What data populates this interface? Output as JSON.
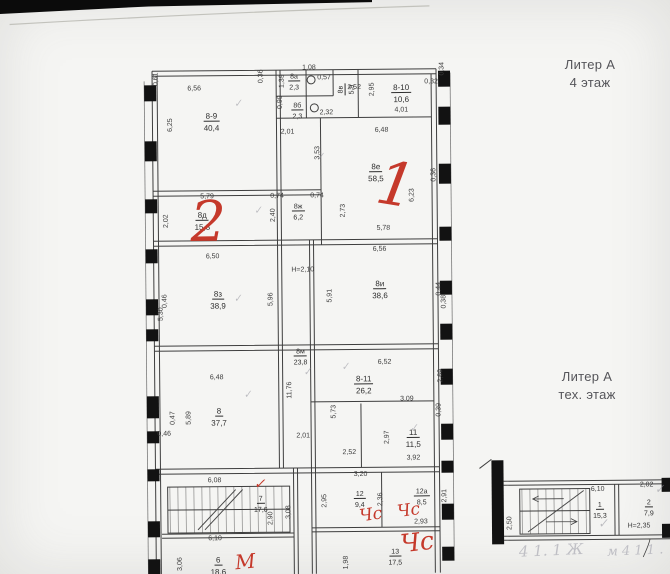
{
  "page": {
    "floor_labels": [
      {
        "line1": "Литер А",
        "line2": "4 этаж"
      },
      {
        "line1": "Литер А",
        "line2": "тех. этаж"
      }
    ]
  },
  "colors": {
    "red": "#c5392b",
    "pencil": "#a6a6b0",
    "tick": "#8f8f99"
  },
  "plan": {
    "rooms": [
      {
        "n": "8-9",
        "a": "40,4",
        "x": 213,
        "y": 119
      },
      {
        "n": "8а",
        "a": "2,3",
        "x": 296,
        "y": 79,
        "s": 1
      },
      {
        "n": "8б",
        "a": "2,3",
        "x": 299,
        "y": 108,
        "s": 1
      },
      {
        "n": "8в",
        "a": "5,9",
        "x": 345,
        "y": 90,
        "s": 1,
        "v": 1
      },
      {
        "n": "8-10",
        "a": "10,6",
        "x": 403,
        "y": 92
      },
      {
        "n": "8е",
        "a": "58,5",
        "x": 377,
        "y": 171
      },
      {
        "n": "8д",
        "a": "15,3",
        "x": 203,
        "y": 218
      },
      {
        "n": "8ж",
        "a": "6,2",
        "x": 299,
        "y": 209,
        "s": 1
      },
      {
        "n": "8з",
        "a": "38,9",
        "x": 218,
        "y": 297
      },
      {
        "n": "8и",
        "a": "38,6",
        "x": 380,
        "y": 288
      },
      {
        "n": "8м",
        "a": "23,8",
        "x": 300,
        "y": 354,
        "s": 1
      },
      {
        "n": "8",
        "a": "37,7",
        "x": 218,
        "y": 414
      },
      {
        "n": "8-11",
        "a": "26,2",
        "x": 363,
        "y": 383
      },
      {
        "n": "11",
        "a": "11,5",
        "x": 412,
        "y": 437
      },
      {
        "n": "7",
        "a": "17,6",
        "x": 259,
        "y": 501,
        "s": 1
      },
      {
        "n": "6",
        "a": "18,6",
        "x": 216,
        "y": 563
      },
      {
        "n": "12",
        "a": "9,4",
        "x": 358,
        "y": 497,
        "s": 1
      },
      {
        "n": "12а",
        "a": "8,5",
        "x": 420,
        "y": 495,
        "s": 1
      },
      {
        "n": "13",
        "a": "17,5",
        "x": 393,
        "y": 555,
        "s": 1
      },
      {
        "n": "1",
        "a": "15,3",
        "x": 598,
        "y": 510,
        "s": 1
      },
      {
        "n": "2",
        "a": "7,9",
        "x": 647,
        "y": 508,
        "s": 1
      }
    ],
    "dims": [
      {
        "t": "0,61",
        "x": 158,
        "y": 78,
        "v": 1
      },
      {
        "t": "6,56",
        "x": 196,
        "y": 88
      },
      {
        "t": "6,25",
        "x": 172,
        "y": 124,
        "v": 1
      },
      {
        "t": "0,36",
        "x": 263,
        "y": 76,
        "v": 1
      },
      {
        "t": "1,08",
        "x": 311,
        "y": 68
      },
      {
        "t": "1,39",
        "x": 284,
        "y": 81,
        "v": 1
      },
      {
        "t": "0,57",
        "x": 326,
        "y": 78
      },
      {
        "t": "0,99",
        "x": 282,
        "y": 102,
        "v": 1
      },
      {
        "t": "2,32",
        "x": 328,
        "y": 113
      },
      {
        "t": "2,52",
        "x": 356,
        "y": 88
      },
      {
        "t": "2,95",
        "x": 374,
        "y": 90,
        "v": 1
      },
      {
        "t": "4,01",
        "x": 403,
        "y": 111
      },
      {
        "t": "0,32",
        "x": 433,
        "y": 83
      },
      {
        "t": "0,34",
        "x": 444,
        "y": 70,
        "v": 1
      },
      {
        "t": "2,01",
        "x": 289,
        "y": 132
      },
      {
        "t": "6,48",
        "x": 383,
        "y": 131
      },
      {
        "t": "3,53",
        "x": 319,
        "y": 153,
        "v": 1
      },
      {
        "t": "0,74",
        "x": 278,
        "y": 196
      },
      {
        "t": "0,74",
        "x": 318,
        "y": 196
      },
      {
        "t": "6,23",
        "x": 413,
        "y": 196,
        "v": 1
      },
      {
        "t": "5,78",
        "x": 384,
        "y": 229
      },
      {
        "t": "2,73",
        "x": 344,
        "y": 211,
        "v": 1
      },
      {
        "t": "0,36",
        "x": 435,
        "y": 176,
        "v": 1
      },
      {
        "t": "5,79",
        "x": 208,
        "y": 196
      },
      {
        "t": "2,02",
        "x": 167,
        "y": 220,
        "v": 1
      },
      {
        "t": "2,40",
        "x": 274,
        "y": 215,
        "v": 1
      },
      {
        "t": "6,50",
        "x": 213,
        "y": 256
      },
      {
        "t": "H=2,10",
        "x": 303,
        "y": 270
      },
      {
        "t": "5,96",
        "x": 271,
        "y": 299,
        "v": 1
      },
      {
        "t": "0,46",
        "x": 165,
        "y": 300,
        "v": 1
      },
      {
        "t": "5,30",
        "x": 161,
        "y": 313,
        "v": 1
      },
      {
        "t": "6,56",
        "x": 380,
        "y": 250
      },
      {
        "t": "5,91",
        "x": 330,
        "y": 296,
        "v": 1
      },
      {
        "t": "0,44",
        "x": 439,
        "y": 290,
        "v": 1
      },
      {
        "t": "0,38",
        "x": 444,
        "y": 303,
        "v": 1
      },
      {
        "t": "6,48",
        "x": 216,
        "y": 377
      },
      {
        "t": "5,89",
        "x": 188,
        "y": 417,
        "v": 1
      },
      {
        "t": "0,47",
        "x": 172,
        "y": 417,
        "v": 1
      },
      {
        "t": "0,46",
        "x": 163,
        "y": 433
      },
      {
        "t": "11,76",
        "x": 289,
        "y": 390,
        "v": 1
      },
      {
        "t": "6,52",
        "x": 384,
        "y": 363
      },
      {
        "t": "2,69",
        "x": 440,
        "y": 377,
        "v": 1
      },
      {
        "t": "5,73",
        "x": 333,
        "y": 412,
        "v": 1
      },
      {
        "t": "3,09",
        "x": 406,
        "y": 400
      },
      {
        "t": "0,39",
        "x": 438,
        "y": 411,
        "v": 1
      },
      {
        "t": "2,97",
        "x": 386,
        "y": 438,
        "v": 1
      },
      {
        "t": "3,92",
        "x": 412,
        "y": 459
      },
      {
        "t": "2,52",
        "x": 348,
        "y": 453
      },
      {
        "t": "2,01",
        "x": 302,
        "y": 436
      },
      {
        "t": "6,08",
        "x": 213,
        "y": 480
      },
      {
        "t": "2,90",
        "x": 269,
        "y": 518,
        "v": 1
      },
      {
        "t": "3,08",
        "x": 287,
        "y": 512,
        "v": 1
      },
      {
        "t": "6,10",
        "x": 213,
        "y": 538
      },
      {
        "t": "3,06",
        "x": 178,
        "y": 563,
        "v": 1
      },
      {
        "t": "3,20",
        "x": 359,
        "y": 475
      },
      {
        "t": "2,95",
        "x": 323,
        "y": 501,
        "v": 1
      },
      {
        "t": "2,36",
        "x": 379,
        "y": 500,
        "v": 1
      },
      {
        "t": "2,91",
        "x": 443,
        "y": 497,
        "v": 1
      },
      {
        "t": "2,93",
        "x": 419,
        "y": 523
      },
      {
        "t": "1,98",
        "x": 344,
        "y": 563,
        "v": 1
      },
      {
        "t": "6,10",
        "x": 596,
        "y": 492
      },
      {
        "t": "2,50",
        "x": 508,
        "y": 525,
        "v": 1
      },
      {
        "t": "2,02",
        "x": 645,
        "y": 488
      },
      {
        "t": "Н=2,35",
        "x": 637,
        "y": 529
      }
    ],
    "notes": [
      {
        "t": "1",
        "x": 397,
        "y": 186,
        "fs": 60,
        "c": "red",
        "rot": 10
      },
      {
        "t": "2",
        "x": 209,
        "y": 222,
        "fs": 56,
        "c": "red",
        "rot": 0
      },
      {
        "t": "Чс",
        "x": 369,
        "y": 516,
        "fs": 17,
        "c": "red",
        "rot": -8
      },
      {
        "t": "Чс",
        "x": 407,
        "y": 512,
        "fs": 17,
        "c": "red",
        "rot": -8
      },
      {
        "t": "Чс",
        "x": 415,
        "y": 543,
        "fs": 25,
        "c": "red",
        "rot": -6
      },
      {
        "t": "М",
        "x": 243,
        "y": 561,
        "fs": 20,
        "c": "red",
        "rot": -5
      },
      {
        "t": "✓",
        "x": 258,
        "y": 484,
        "fs": 14,
        "c": "red",
        "rot": 0
      },
      {
        "t": "✓",
        "x": 240,
        "y": 104,
        "fs": 10,
        "c": "tick",
        "rot": -10
      },
      {
        "t": "✓",
        "x": 322,
        "y": 158,
        "fs": 10,
        "c": "tick",
        "rot": -10
      },
      {
        "t": "✓",
        "x": 259,
        "y": 211,
        "fs": 10,
        "c": "tick",
        "rot": -10
      },
      {
        "t": "✓",
        "x": 238,
        "y": 299,
        "fs": 10,
        "c": "tick",
        "rot": -10
      },
      {
        "t": "✓",
        "x": 247,
        "y": 395,
        "fs": 10,
        "c": "tick",
        "rot": -10
      },
      {
        "t": "✓",
        "x": 307,
        "y": 373,
        "fs": 10,
        "c": "tick",
        "rot": -10
      },
      {
        "t": "✓",
        "x": 345,
        "y": 368,
        "fs": 10,
        "c": "tick",
        "rot": -10
      },
      {
        "t": "✓",
        "x": 413,
        "y": 430,
        "fs": 10,
        "c": "tick",
        "rot": -10
      },
      {
        "t": "✓",
        "x": 601,
        "y": 526,
        "fs": 12,
        "c": "tick",
        "rot": -5
      },
      {
        "t": "✓",
        "x": 658,
        "y": 492,
        "fs": 12,
        "c": "tick",
        "rot": -5
      },
      {
        "t": "4 1. 1 Ж",
        "x": 549,
        "y": 553,
        "fs": 15,
        "c": "pencil",
        "rot": -2
      },
      {
        "t": "м 4 1 1 .",
        "x": 633,
        "y": 554,
        "fs": 13,
        "c": "pencil",
        "rot": -2
      }
    ]
  }
}
